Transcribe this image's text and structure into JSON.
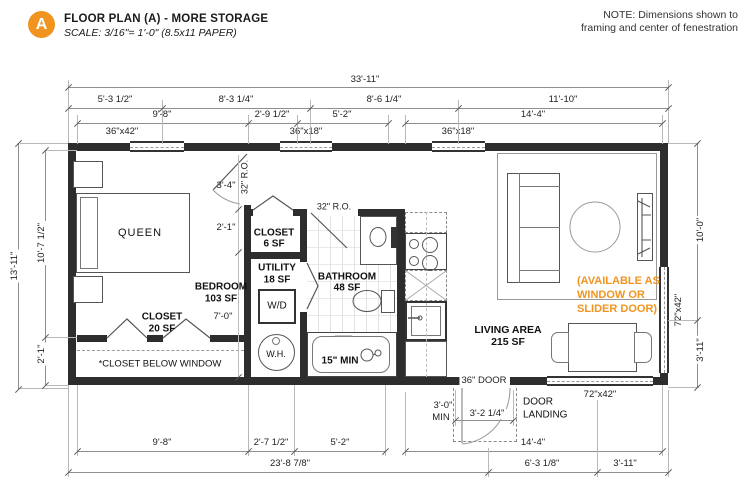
{
  "title_block": {
    "marker": "A",
    "title": "FLOOR PLAN (A) - MORE STORAGE",
    "scale": "SCALE: 3/16\"= 1'-0\" (8.5x11 PAPER)"
  },
  "note": {
    "line1": "NOTE: Dimensions shown to",
    "line2": "framing and center of fenestration"
  },
  "dims": {
    "overall_width": "33'-11\"",
    "top_row2": [
      "5'-3 1/2\"",
      "8'-3 1/4\"",
      "8'-6 1/4\"",
      "11'-10\""
    ],
    "top_row3": [
      "9'-8\"",
      "2'-9 1/2\"",
      "5'-2\"",
      "14'-4\""
    ],
    "bottom_row1": [
      "9'-8\"",
      "2'-7 1/2\"",
      "5'-2\"",
      "14'-4\""
    ],
    "bottom_row2": [
      "23'-8 7/8\"",
      "6'-3 1/8\"",
      "3'-11\""
    ],
    "left_overall": "13'-11\"",
    "left_upper": "10'-7 1/2\"",
    "left_lower": "2'-1\"",
    "right_upper": "10'-0\"",
    "right_lower": "3'-11\"",
    "closet_depth": "2'-1\"",
    "bedroom_width": "7'-0\"",
    "bedroom_door": "3'-4\"",
    "bedroom_door_ro": "32\" R.O.",
    "bath_door_ro": "32\" R.O.",
    "tub_min": "15\" MIN",
    "landing_width": "3'-2 1/4\"",
    "landing_min1": "3'-0\"",
    "landing_min2": "MIN"
  },
  "windows": {
    "top1": "36\"x42\"",
    "top2": "36\"x18\"",
    "top3": "36\"x18\"",
    "right": "72\"x42\"",
    "bottom": "72\"x42\""
  },
  "rooms": {
    "bedroom": {
      "name": "BEDROOM",
      "area": "103 SF"
    },
    "closet_bedroom": {
      "name": "CLOSET",
      "area": "20 SF"
    },
    "closet_hall": {
      "name": "CLOSET",
      "area": "6 SF"
    },
    "utility": {
      "name": "UTILITY",
      "area": "18 SF"
    },
    "bathroom": {
      "name": "BATHROOM",
      "area": "48 SF"
    },
    "living": {
      "name": "LIVING AREA",
      "area": "215 SF"
    }
  },
  "fixtures": {
    "bed": "QUEEN",
    "washer_dryer": "W/D",
    "water_heater": "W.H."
  },
  "annotations": {
    "closet_below_window": "*CLOSET BELOW WINDOW",
    "door_36": "36\" DOOR",
    "door_landing_l1": "DOOR",
    "door_landing_l2": "LANDING",
    "available_l1": "(AVAILABLE AS",
    "available_l2": "WINDOW OR",
    "available_l3": "SLIDER DOOR)"
  },
  "colors": {
    "accent_orange": "#F0941F",
    "wall": "#2d2d2d",
    "dim_line": "#8f8f8f",
    "text": "#1a1a1a"
  }
}
